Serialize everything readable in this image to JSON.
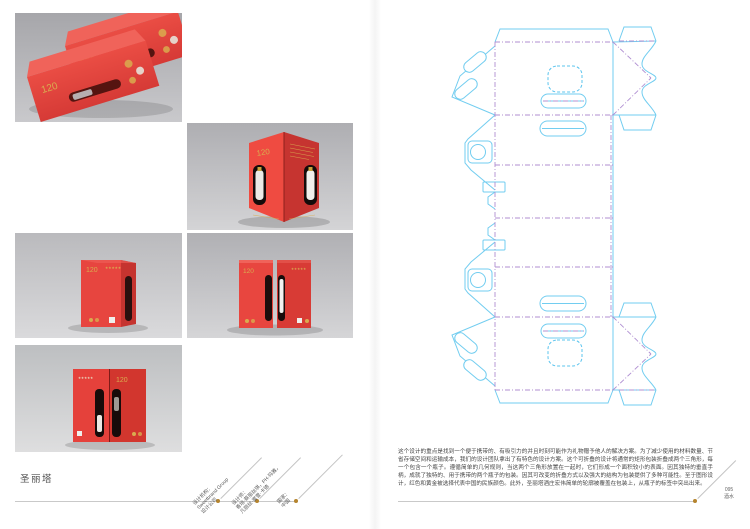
{
  "colors": {
    "box_red": "#e2413d",
    "gold": "#d9ab4f",
    "dieline_cut": "#72cdf0",
    "dieline_fold": "#b08fd2",
    "accent_dot": "#b5842e"
  },
  "left_page": {
    "title": "圣丽塔",
    "packaging": {
      "brand": "120",
      "stars": "★★★★★"
    },
    "credits": [
      {
        "label": "设计机构：",
        "line2": "Sweetbrand Group",
        "line3": "设计公司"
      },
      {
        "label": "设计师：",
        "line2": "香培·蔡丽丝琪，PH·玛雅，",
        "line3": "凡丽丝·蜜雪·卡德"
      },
      {
        "label": "国家：",
        "line2": "中国",
        "line3": ""
      }
    ]
  },
  "right_page": {
    "description": "这个设计的重点是找到一个便于携带的、有吸引力的并且时刻可能作为礼物赠予他人的解决方案。为了减少使用的材料数量、节省存储空间和运输成本，我们的设计团队拿出了有特色的设计方案。这个可折叠的设计将通常的矩形包装折叠成两个三角形，每一个包含一个瓶子。遵循简单的几何规则，当这两个三角形放置在一起时，它们形成一个面积较小的表面。因其独特的垂直手柄，成就了独特的、用于携带的两个瓶子的包装。因其可改变的折叠方式以及强大的结构为包装提供了多种可能性。至于图形设计，红色和黄金被选择代表中国的民族颜色。此外，圣丽塔酒庄宏伟简单的轮廓被覆盖在包装上，从瓶子的标签中突出出来。",
    "page_label": {
      "number": "095",
      "section": "酒水"
    }
  }
}
